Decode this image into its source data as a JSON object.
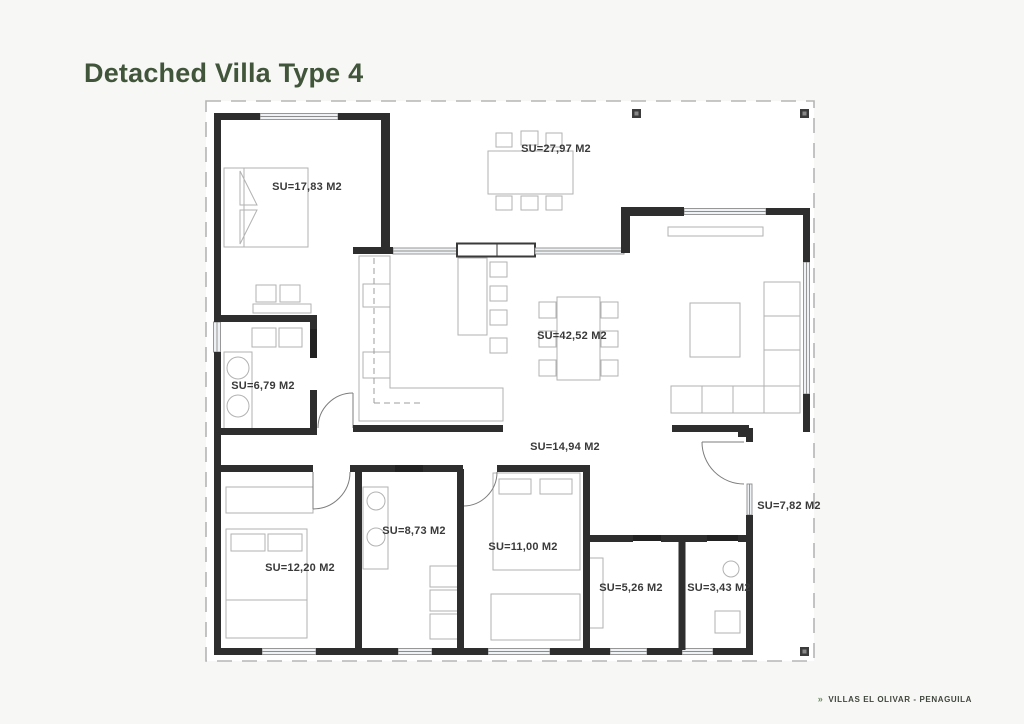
{
  "page": {
    "title": "Detached Villa Type 4"
  },
  "footer": {
    "marker": "»",
    "text": "VILLAS EL OLIVAR - PENAGUILA"
  },
  "colors": {
    "background": "#f7f7f5",
    "title_green": "#41553a",
    "footer_green": "#6b8a5e",
    "wall": "#2e2e2e",
    "furniture_line": "#b2b2b2",
    "boundary_dash": "#b5b5b5",
    "label_text": "#3a3a3a"
  },
  "rooms": [
    {
      "id": "terrace",
      "label": "SU=27,97 M2"
    },
    {
      "id": "bedroom-1",
      "label": "SU=17,83 M2"
    },
    {
      "id": "living-room",
      "label": "SU=42,52 M2"
    },
    {
      "id": "bathroom-1",
      "label": "SU=6,79 M2"
    },
    {
      "id": "hallway",
      "label": "SU=14,94 M2"
    },
    {
      "id": "bedroom-2",
      "label": "SU=12,20 M2"
    },
    {
      "id": "bathroom-2",
      "label": "SU=8,73 M2"
    },
    {
      "id": "bedroom-3",
      "label": "SU=11,00 M2"
    },
    {
      "id": "storage",
      "label": "SU=5,26 M2"
    },
    {
      "id": "bathroom-3",
      "label": "SU=3,43 M2"
    },
    {
      "id": "side-porch",
      "label": "SU=7,82 M2"
    }
  ]
}
